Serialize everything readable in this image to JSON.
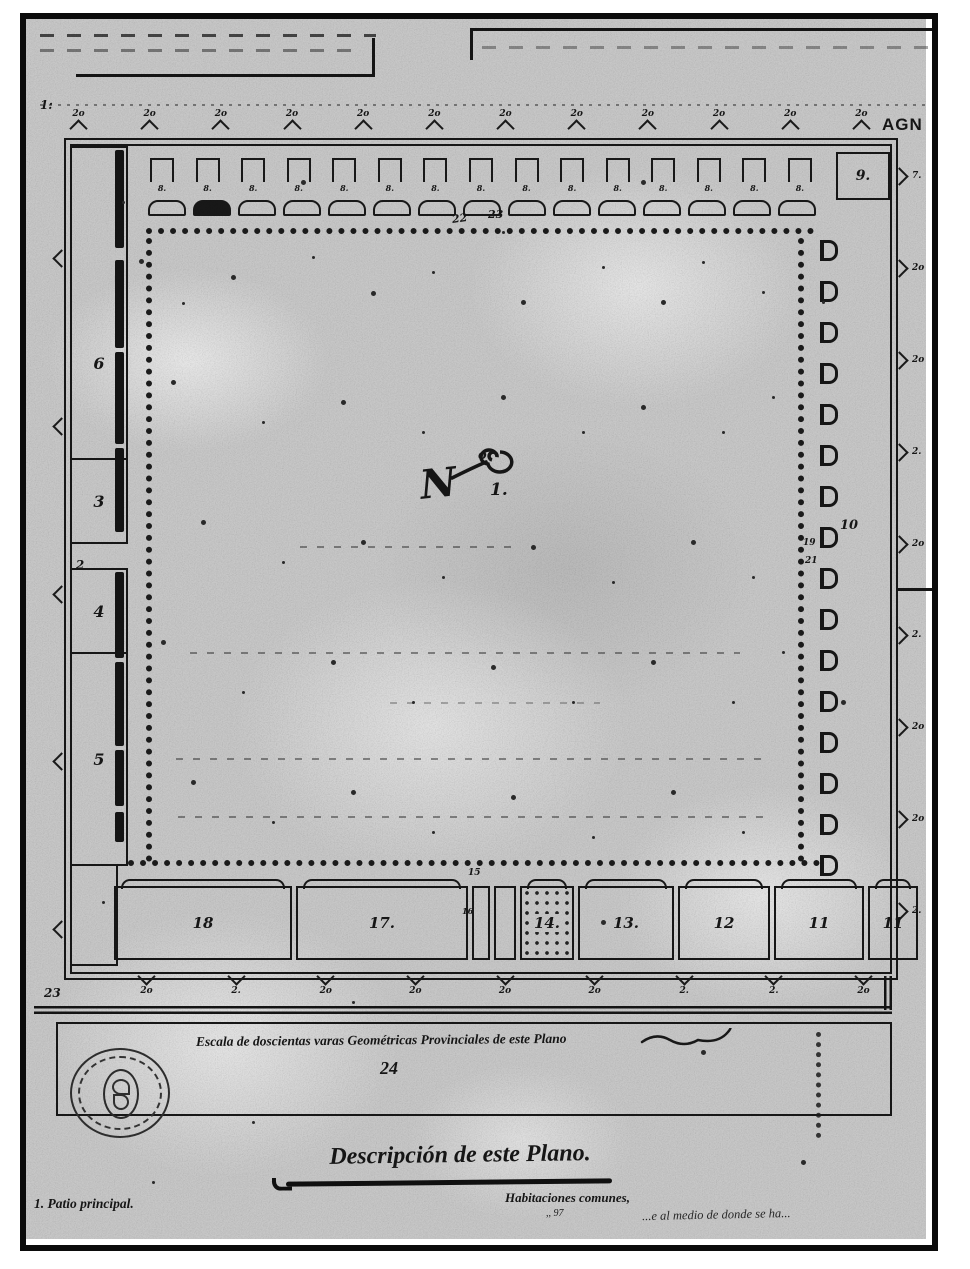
{
  "document": {
    "watermark": "AGN",
    "corner_mark_top_left": "1:",
    "title": "Descripción de este Plano.",
    "scale_caption": "Escala de doscientas varas Geométricas Provinciales de este Plano",
    "scale_number": "24",
    "caption_left": "1. Patio principal.",
    "caption_center": "Habitaciones comunes,",
    "caption_center_sub": ",, 97",
    "caption_right": "...e al medio de donde se ha..."
  },
  "plan": {
    "monogram": {
      "letter": "N",
      "ordinal": "o",
      "number": "1."
    },
    "rooms": {
      "left": [
        "6",
        "3",
        "2",
        "4",
        "5"
      ],
      "top_right": "9.",
      "bottom": [
        "18",
        "17.",
        "14.",
        "13.",
        "12",
        "11",
        "11"
      ]
    },
    "labels": {
      "dot_row_a": "22",
      "dot_row_b": "23",
      "gallery": "10",
      "gallery_a": "19",
      "gallery_b": "21",
      "outside_bottom_left": "23",
      "gap_above": "15",
      "corridor": "16"
    },
    "repeat": {
      "top_bastions": [
        "2o",
        "2o",
        "2o",
        "2o",
        "2o",
        "2o",
        "2o",
        "2o",
        "2o",
        "2o",
        "2o",
        "2o"
      ],
      "niches": [
        "8.",
        "8.",
        "8.",
        "8.",
        "8.",
        "8.",
        "8.",
        "8.",
        "8.",
        "8.",
        "8.",
        "8.",
        "8.",
        "8.",
        "8."
      ],
      "right_wall": [
        "7.",
        "2o",
        "2o",
        "2.",
        "2o",
        "2.",
        "2o",
        "2o",
        "2."
      ],
      "bottom_wall": [
        "2o",
        "2.",
        "2o",
        "2o",
        "2o",
        "2o",
        "2.",
        "2.",
        "2o"
      ]
    }
  }
}
